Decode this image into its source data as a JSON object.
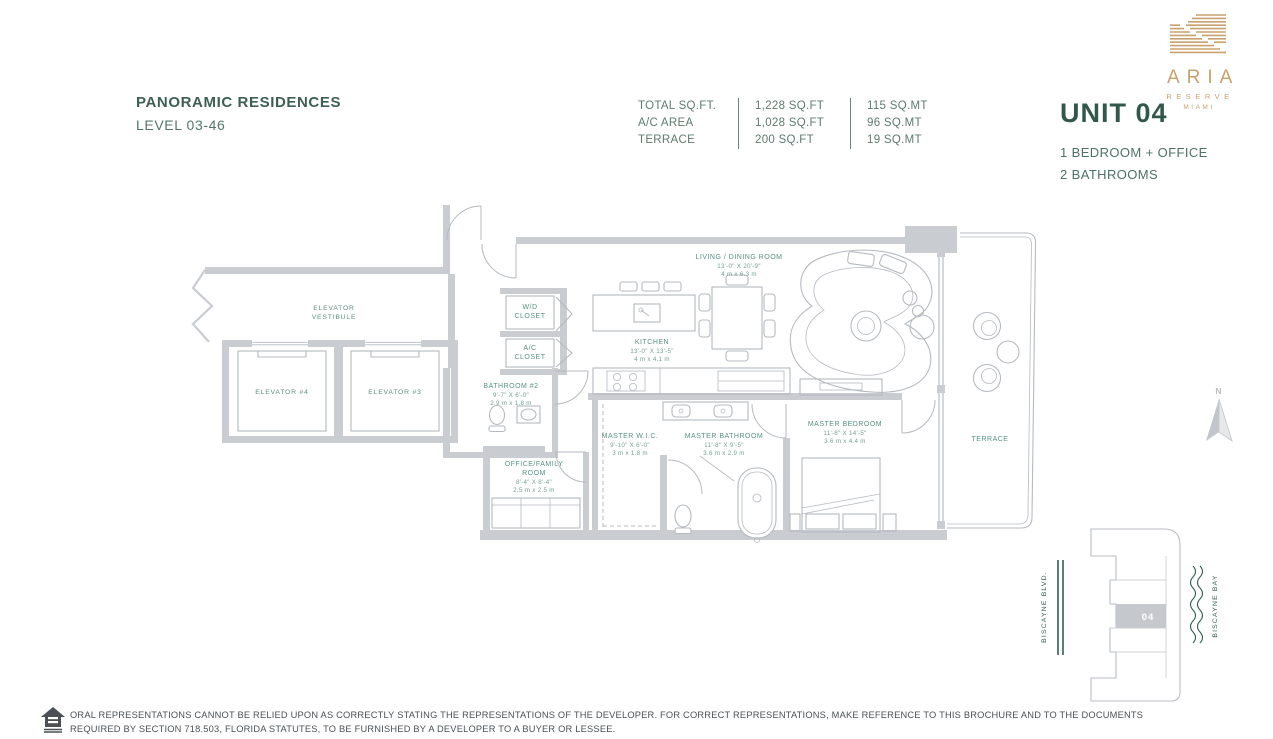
{
  "header": {
    "title": "PANORAMIC RESIDENCES",
    "subtitle": "LEVEL 03-46"
  },
  "stats": {
    "rows": [
      {
        "label": "TOTAL SQ.FT.",
        "sqft": "1,228 SQ.FT",
        "sqmt": "115 SQ.MT"
      },
      {
        "label": "A/C AREA",
        "sqft": "1,028 SQ.FT",
        "sqmt": "96 SQ.MT"
      },
      {
        "label": "TERRACE",
        "sqft": "200 SQ.FT",
        "sqmt": "19 SQ.MT"
      }
    ]
  },
  "brand": {
    "name": "ARIA",
    "line2": "RESERVE",
    "line3": "MIAMI"
  },
  "unit": {
    "title": "UNIT 04",
    "line1": "1 BEDROOM + OFFICE",
    "line2": "2 BATHROOMS"
  },
  "plan": {
    "compass": "N",
    "rooms": {
      "vestibule": {
        "l1": "ELEVATOR",
        "l2": "VESTIBULE"
      },
      "elevator4": {
        "name": "ELEVATOR #4"
      },
      "elevator3": {
        "name": "ELEVATOR #3"
      },
      "wd": {
        "l1": "W/D",
        "l2": "CLOSET"
      },
      "ac": {
        "l1": "A/C",
        "l2": "CLOSET"
      },
      "bath2": {
        "name": "BATHROOM #2",
        "ft": "9'-7\" X 6'-0\"",
        "m": "2.9 m x 1.8 m"
      },
      "office": {
        "l1": "OFFICE/FAMILY",
        "l2": "ROOM",
        "ft": "8'-4\" X 8'-4\"",
        "m": "2.5 m x 2.5 m"
      },
      "kitchen": {
        "name": "KITCHEN",
        "ft": "13'-0\" X 13'-5\"",
        "m": "4 m x 4.1 m"
      },
      "living": {
        "name": "LIVING / DINING ROOM",
        "ft": "13'-0\" X 20'-9\"",
        "m": "4 m x 6.3 m"
      },
      "wic": {
        "name": "MASTER W.I.C.",
        "ft": "9'-10\" X 6'-0\"",
        "m": "3 m x 1.8 m"
      },
      "mbath": {
        "name": "MASTER BATHROOM",
        "ft": "11'-8\" X 9'-5\"",
        "m": "3.6 m x 2.9 m"
      },
      "mbed": {
        "name": "MASTER BEDROOM",
        "ft": "11'-8\" X 14'-5\"",
        "m": "3.6 m x 4.4 m"
      },
      "terrace": {
        "name": "TERRACE"
      }
    }
  },
  "keyplan": {
    "street": "BISCAYNE BLVD.",
    "bay": "BISCAYNE BAY",
    "unit": "04"
  },
  "disclaimer": {
    "line1": "ORAL REPRESENTATIONS CANNOT BE RELIED UPON AS CORRECTLY STATING THE REPRESENTATIONS OF THE DEVELOPER. FOR CORRECT REPRESENTATIONS, MAKE REFERENCE TO THIS BROCHURE AND TO THE DOCUMENTS",
    "line2": "REQUIRED BY SECTION 718.503, FLORIDA STATUTES, TO BE FURNISHED BY A DEVELOPER TO A BUYER OR LESSEE."
  },
  "colors": {
    "accent_green": "#3d6053",
    "label_teal": "#579184",
    "wall_gray": "#c9ccd1",
    "logo_gold": "#c8a16d",
    "keyplan_green": "#31604f"
  }
}
